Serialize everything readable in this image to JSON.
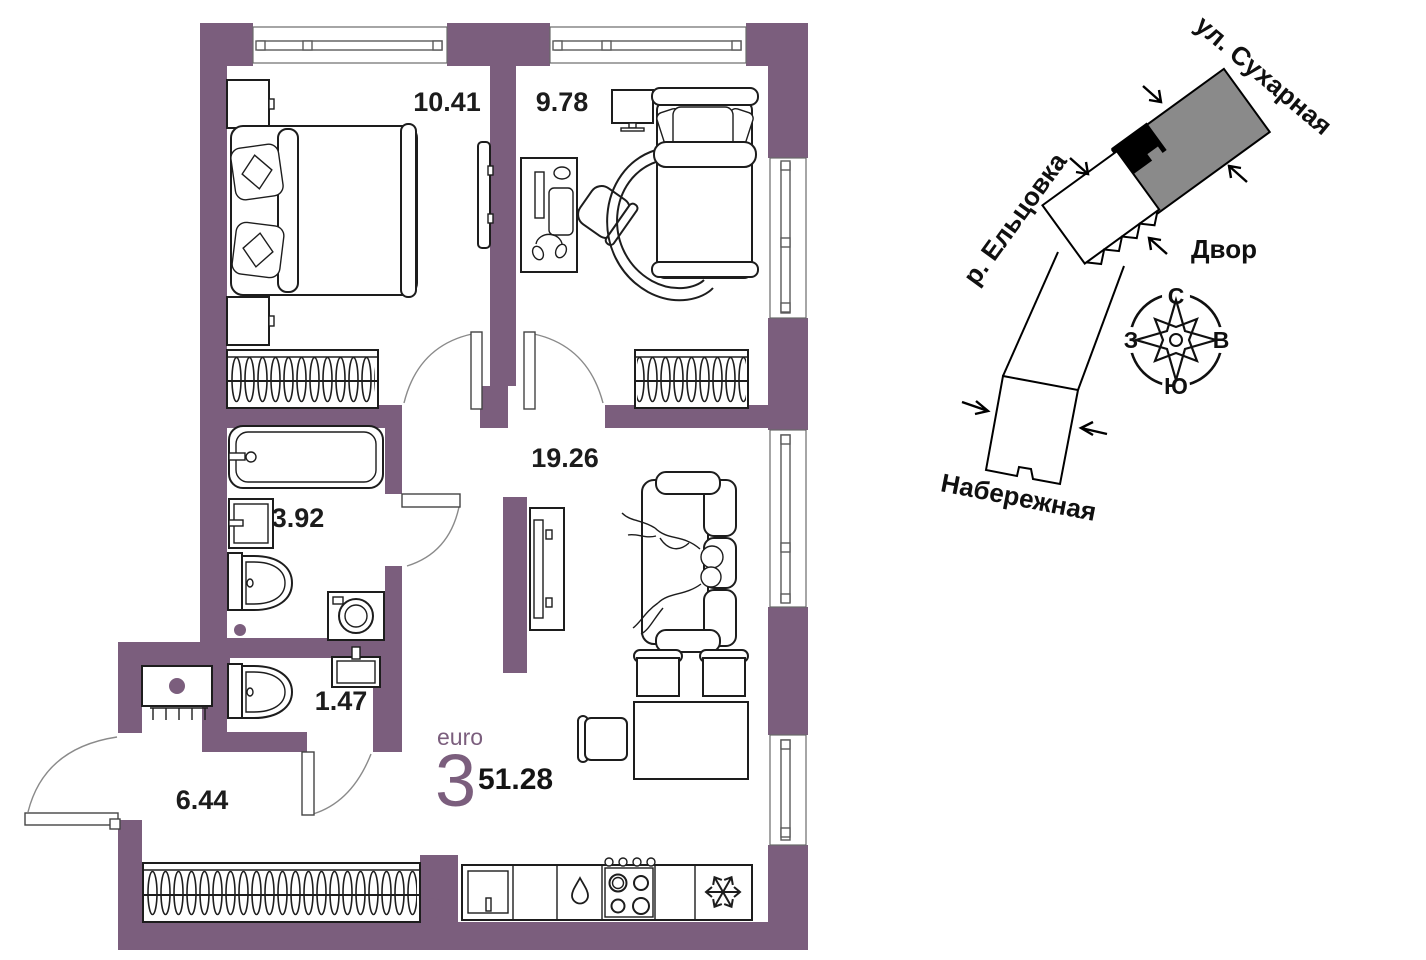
{
  "plan": {
    "unit_type_label": "euro",
    "rooms_count": "3",
    "total_area": "51.28",
    "rooms": [
      {
        "name": "bedroom-1",
        "area": "10.41"
      },
      {
        "name": "bedroom-2",
        "area": "9.78"
      },
      {
        "name": "living-dining",
        "area": "19.26"
      },
      {
        "name": "bathroom",
        "area": "3.92"
      },
      {
        "name": "wc",
        "area": "1.47"
      },
      {
        "name": "hallway",
        "area": "6.44"
      }
    ]
  },
  "minimap": {
    "labels": {
      "street": "ул. Сухарная",
      "river": "р. Ельцовка",
      "yard": "Двор",
      "embankment": "Набережная"
    },
    "compass": {
      "n": "С",
      "s": "Ю",
      "w": "З",
      "e": "В"
    }
  },
  "icons": {
    "fridge": "snowflake-icon",
    "kitchen_sink": "water-drop-icon",
    "compass": "compass-rose-icon"
  },
  "colors": {
    "wall": "#7b5e7d",
    "accent": "#7b5e7d",
    "building_highlight": "#8a8a8a",
    "building_marker": "#000000",
    "line": "#1d1d1d"
  }
}
